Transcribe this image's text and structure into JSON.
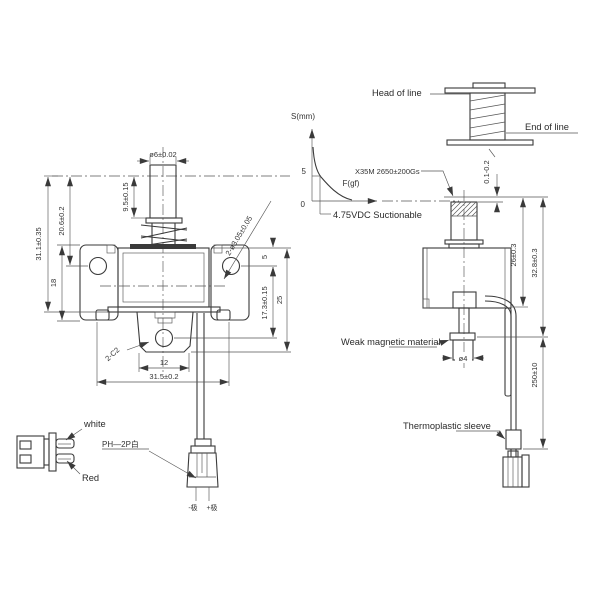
{
  "colors": {
    "background": "#ffffff",
    "line": "#3a3a3a",
    "text": "#333333"
  },
  "coil_detail": {
    "head_label": "Head of line",
    "end_label": "End of line"
  },
  "graph": {
    "y_axis_label": "S(mm)",
    "x_axis_label": "F(gf)",
    "y_tick_5": "5",
    "origin": "0",
    "magnet_note": "X35M 2650±200Gs",
    "voltage_note": "4.75VDC Suctionable"
  },
  "front_view": {
    "dim_rod_diameter": "ø6±0.02",
    "dim_spring_height": "9.5±0.15",
    "dim_overall_height": "31.1±0.35",
    "dim_upper_height": "20.6±0.2",
    "dim_bracket_height": "18",
    "dim_hole_offset": "5",
    "dim_lower_height": "17.3±0.15",
    "dim_body_height": "25",
    "dim_slot_width": "12",
    "dim_mount_width": "31.5±0.2",
    "chamfer_note": "2-C2",
    "mount_hole_note": "2-ø3.05±0.05"
  },
  "side_view": {
    "dim_air_gap": "0.1-0.2",
    "dim_body_height": "26±0.3",
    "dim_overall_height": "32.8±0.3",
    "dim_lead_length": "250±10",
    "dim_plunger_diameter": "ø4",
    "material_note": "Weak magnetic material",
    "sleeve_note": "Thermoplastic sleeve"
  },
  "connector_detail": {
    "wire_white": "white",
    "wire_red": "Red",
    "connector_type": "PH—2P白",
    "negative_pole": "-极",
    "positive_pole": "+极"
  }
}
